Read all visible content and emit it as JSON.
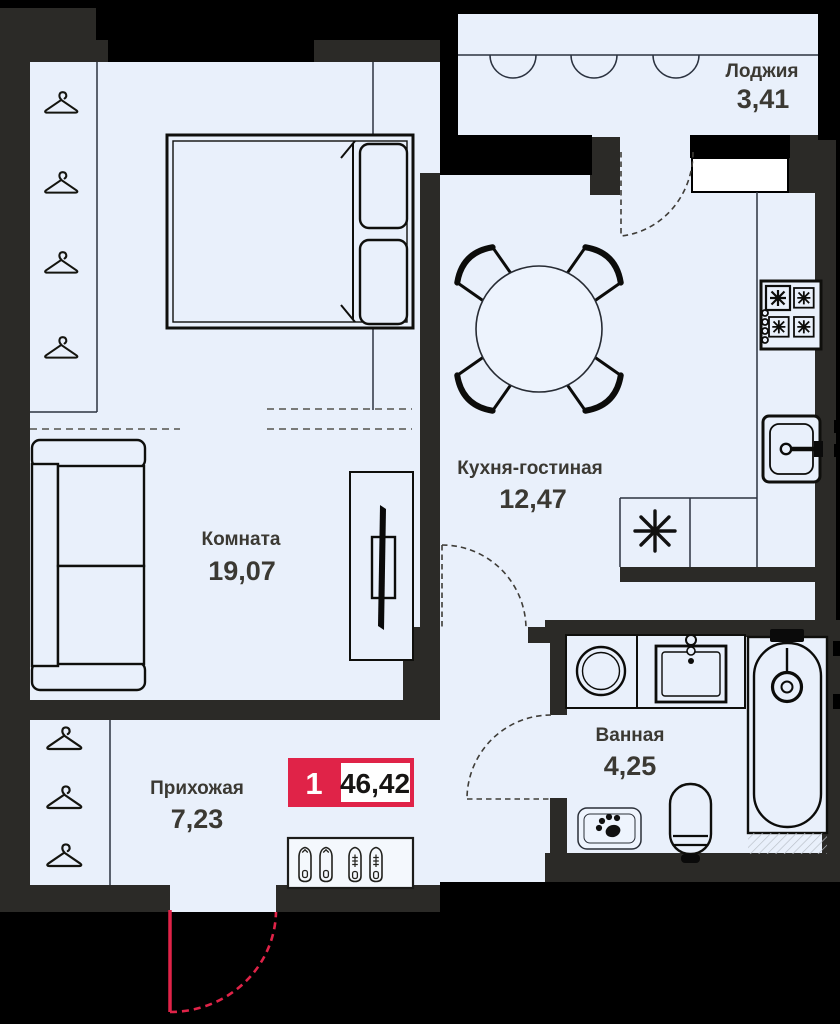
{
  "type": "apartment-floor-plan",
  "badge": {
    "rooms_count": "1",
    "total_area": "46,42"
  },
  "rooms": [
    {
      "name": "Комната",
      "area": "19,07"
    },
    {
      "name": "Кухня-гостиная",
      "area": "12,47"
    },
    {
      "name": "Прихожая",
      "area": "7,23"
    },
    {
      "name": "Ванная",
      "area": "4,25"
    },
    {
      "name": "Лоджия",
      "area": "3,41"
    }
  ],
  "colors": {
    "floor": "#e9f0fb",
    "walls": "#2b2a27",
    "exterior": "#000000",
    "accent": "#e02348",
    "labels": "#3b3933",
    "hatch": "#b9bfc7"
  },
  "icons": [
    "hanger-icon",
    "double-bed-icon",
    "sofa-icon",
    "tv-stand-icon",
    "dining-table-icon",
    "chair-icon",
    "stove-icon",
    "kitchen-sink-icon",
    "vent-asterisk-icon",
    "washing-machine-icon",
    "washbasin-icon",
    "bathtub-icon",
    "toilet-icon",
    "pet-mat-icon",
    "shoe-rack-icon",
    "entrance-door-icon",
    "interior-door-icon",
    "balcony-window-icon",
    "loggia-casement-icon"
  ]
}
